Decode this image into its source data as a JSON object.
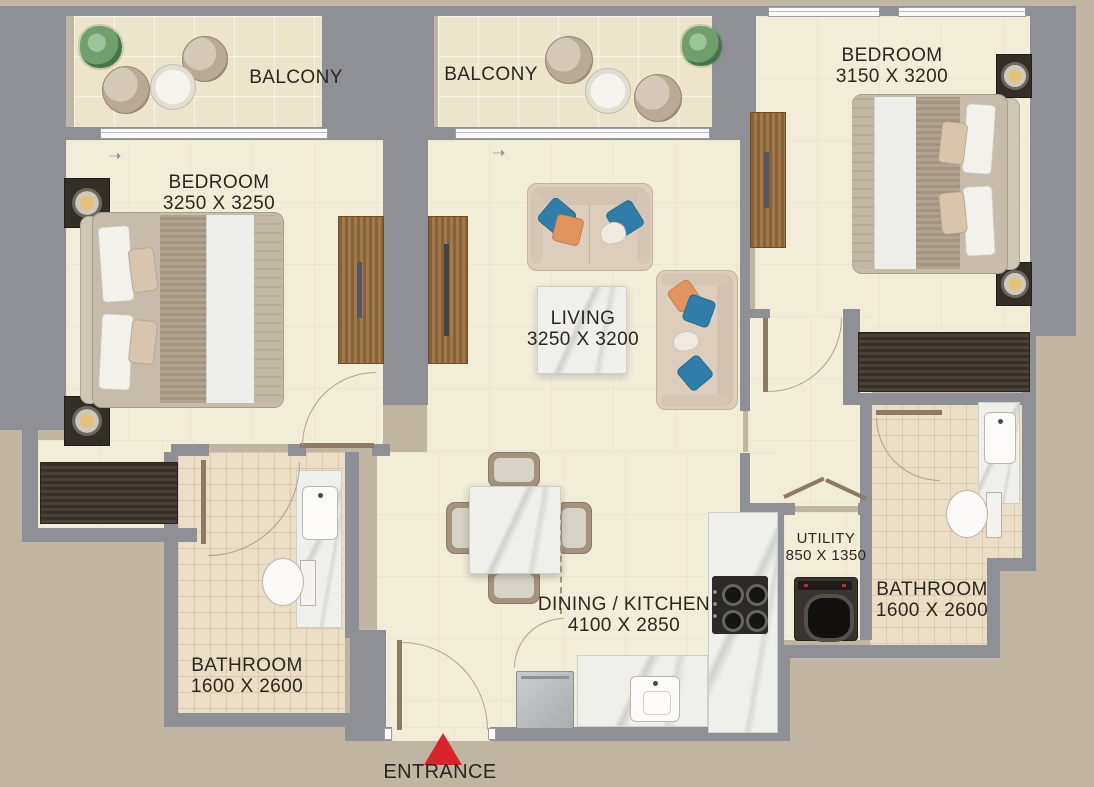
{
  "plan": {
    "type": "apartment-floor-plan",
    "entrance_label": "ENTRANCE",
    "rooms": [
      {
        "name": "balcony-1",
        "label": "BALCONY",
        "dims": ""
      },
      {
        "name": "balcony-2",
        "label": "BALCONY",
        "dims": ""
      },
      {
        "name": "bedroom-1",
        "label": "BEDROOM",
        "dims": "3250 X 3250"
      },
      {
        "name": "bedroom-2",
        "label": "BEDROOM",
        "dims": "3150 X 3200"
      },
      {
        "name": "living",
        "label": "LIVING",
        "dims": "3250 X 3200"
      },
      {
        "name": "dining-kitchen",
        "label": "DINING / KITCHEN",
        "dims": "4100 X 2850"
      },
      {
        "name": "utility",
        "label": "UTILITY",
        "dims": "850 X 1350"
      },
      {
        "name": "bathroom-1",
        "label": "BATHROOM",
        "dims": "1600 X 2600"
      },
      {
        "name": "bathroom-2",
        "label": "BATHROOM",
        "dims": "1600 X 2600"
      }
    ],
    "colors": {
      "exterior": "#c0b4a3",
      "wall": "#8e9095",
      "floor": "#f2edd9",
      "bathroom_tile": "#eadfc6",
      "balcony_tile": "#ece4cb",
      "wood": "#8a6137",
      "dark_wood": "#4a4038",
      "marble": "#eff0ec",
      "sofa": "#dccdbd",
      "pillow_blue": "#2f7da8",
      "pillow_orange": "#e2945f",
      "entrance_arrow_red": "#d8232a"
    }
  }
}
